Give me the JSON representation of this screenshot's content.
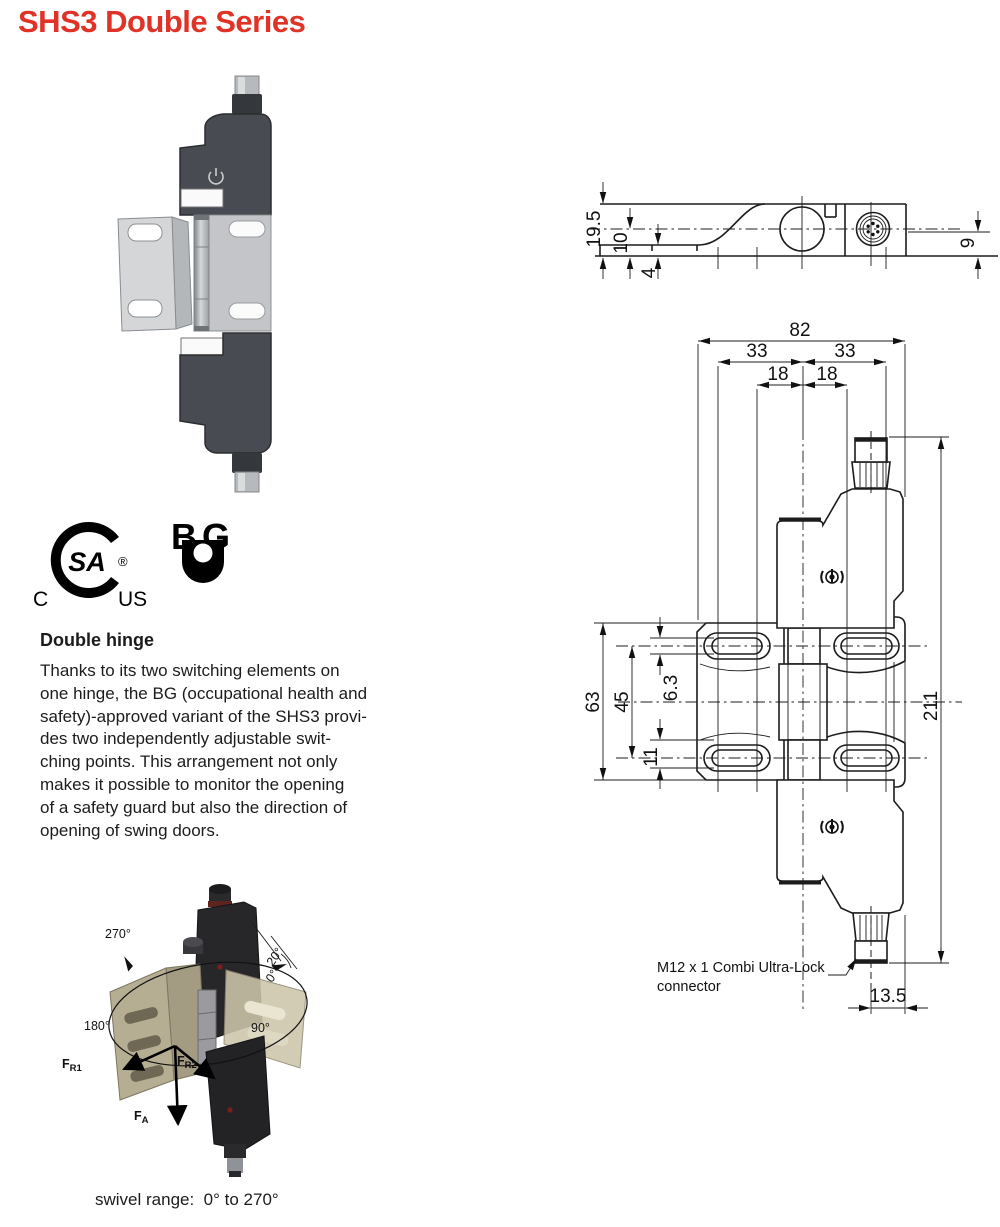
{
  "page": {
    "title": "SHS3 Double Series"
  },
  "colors": {
    "title_red": "#e03226",
    "drawing_line": "#1c1c1c",
    "photo_body_dark": "#474b51",
    "iso_bracket_tan": "#b5ae93"
  },
  "certifications": {
    "csa": {
      "monogram": "SA",
      "registered": "®",
      "left": "C",
      "right": "US"
    },
    "bg": {
      "letter_b": "B",
      "letter_g": "G"
    }
  },
  "description": {
    "heading": "Double hinge",
    "lines": [
      "Thanks to its two switching elements on",
      "one hinge, the BG (occupational health and",
      "safety)-approved variant of the SHS3 provi-",
      "des two independently adjustable swit-",
      "ching points. This arrangement not only",
      "makes it possible to monitor the opening",
      "of a safety guard but also the direction of",
      "opening of swing doors."
    ]
  },
  "iso_view": {
    "angle_270": "270°",
    "angle_180": "180°",
    "angle_90": "90°",
    "angle_20": "20°",
    "angle_0": "0°",
    "force_f": "F",
    "force_r1_sub": "R1",
    "force_r2_sub": "R2",
    "force_a_sub": "A"
  },
  "swivel_note": "swivel range:  0° to 270°",
  "drawing_top_view": {
    "dim_height_total": "19.5",
    "dim_axis_height": "10",
    "dim_plate_thickness": "4",
    "dim_connector_height": "9"
  },
  "drawing_front_view": {
    "dim_width": "82",
    "dim_left_33": "33",
    "dim_right_33": "33",
    "dim_left_18": "18",
    "dim_right_18": "18",
    "dim_plate_height": "63",
    "dim_slot_spacing": "45",
    "dim_slot_width": "6.3",
    "dim_slot_edge": "11",
    "dim_total_height": "211",
    "dim_connector_offset": "13.5",
    "connector_note_line1": "M12 x 1 Combi Ultra-Lock",
    "connector_note_line2": "connector"
  }
}
